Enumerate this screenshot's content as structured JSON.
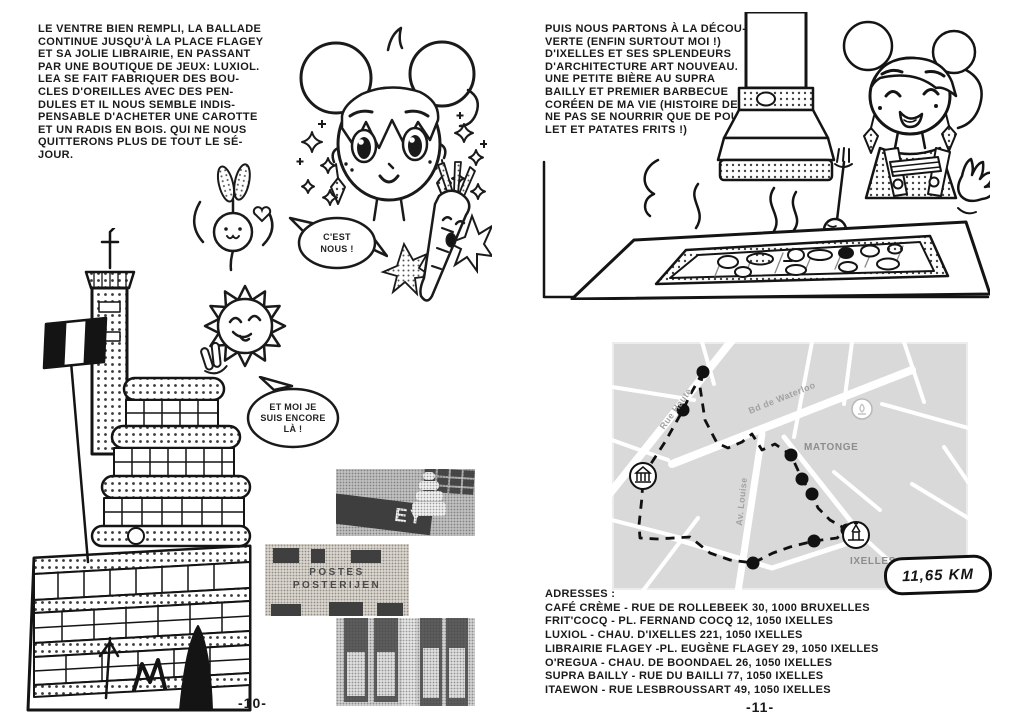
{
  "page_left": {
    "page_number": "-10-",
    "paragraph": "LE VENTRE BIEN REMPLI, LA BALLADE\nCONTINUE JUSQU'À LA PLACE FLAGEY\nET SA JOLIE LIBRAIRIE, EN PASSANT\nPAR UNE BOUTIQUE DE JEUX: LUXIOL.\nLEA SE FAIT FABRIQUER DES BOU-\nCLES D'OREILLES AVEC DES PEN-\nDULES ET IL NOUS SEMBLE INDIS-\nPENSABLE D'ACHETER UNE CAROTTE\nET UN RADIS EN BOIS. QUI NE NOUS\nQUITTERONS PLUS DE TOUT LE SÉ-\nJOUR.",
    "bubble_cest_nous": {
      "line1": "C'EST",
      "line2": "NOUS !"
    },
    "bubble_encore": {
      "line1": "ET MOI JE",
      "line2": "SUIS ENCORE",
      "line3": "LÀ !"
    },
    "photos": {
      "flagey_sign": "EY",
      "post_sign_line1": "POSTES",
      "post_sign_line2": "POSTERIJEN"
    }
  },
  "page_right": {
    "page_number": "-11-",
    "paragraph": "PUIS NOUS PARTONS À LA DÉCOU-\nVERTE (ENFIN SURTOUT MOI !)\nD'IXELLES ET SES SPLENDEURS\nD'ARCHITECTURE ART NOUVEAU.\nUNE PETITE BIÈRE AU SUPRA\nBAILLY ET PREMIER BARBECUE\nCORÉEN DE MA VIE (HISTOIRE DE\nNE PAS SE NOURRIR QUE DE POU-\nLET ET PATATES FRITS !)",
    "map": {
      "streets": {
        "rue_haute": "Rue Haute",
        "bd_waterloo": "Bd de Waterloo",
        "av_louise": "Av. Louise"
      },
      "areas": {
        "matonge": "MATONGE",
        "ixelles": "IXELLES"
      },
      "distance_badge": "11,65 KM"
    },
    "addresses": {
      "title": "ADRESSES :",
      "lines": [
        "CAFÉ CRÈME - RUE DE ROLLEBEEK 30, 1000 BRUXELLES",
        "FRIT'COCQ - PL. FERNAND COCQ 12, 1050 IXELLES",
        "LUXIOL - CHAU. D'IXELLES 221, 1050 IXELLES",
        "LIBRAIRIE FLAGEY -PL. EUGÈNE FLAGEY 29, 1050 IXELLES",
        "O'REGUA - CHAU. DE BOONDAEL 26, 1050 IXELLES",
        "SUPRA BAILLY - RUE DU BAILLI 77, 1050 IXELLES",
        "ITAEWON - RUE LESBROUSSART 49, 1050 IXELLES"
      ]
    }
  },
  "icons": {
    "map_marker_left": "classical-building",
    "map_marker_right": "church-tower",
    "map_marker_top": "fountain",
    "illustrations": [
      "manga-girl-head",
      "radish-character",
      "carrot-character",
      "sun-character",
      "bbq-girl",
      "flagey-building"
    ]
  },
  "colors": {
    "ink": "#141414",
    "map_bg": "#ececec",
    "map_block": "#d9d9d9",
    "map_label": "#9b9b9b",
    "photo_gray": "#c9c9c9"
  }
}
